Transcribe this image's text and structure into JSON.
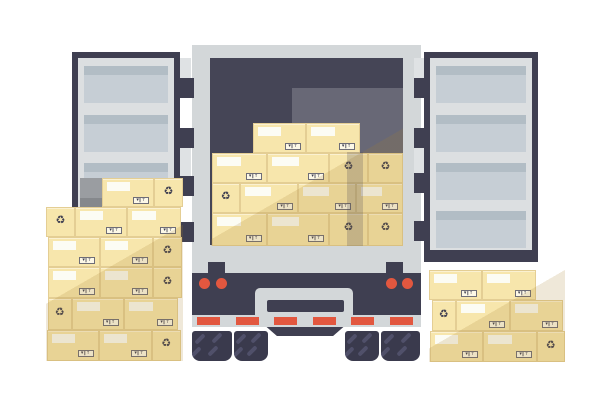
{
  "title": "Flat vector illustration: rear view of a box truck with both cargo doors open, loaded with cardboard boxes, and stacks of cardboard boxes on the ground at the left and right",
  "colors": {
    "background": "#FFFFFF",
    "navy": "#3F3F51",
    "interior": "#454556",
    "interior_light": "#686876",
    "body_gray": "#D3D7D9",
    "door_inner": "#DCDFE1",
    "panel": "#C6CED5",
    "panel_top": "#B2BDC5",
    "hinge_gray": "#DFE2E4",
    "red": "#E2573F",
    "wheel": "#3A3A4D",
    "tread": "#50506A",
    "box_cream": "#F7E6AC",
    "box_border": "#E4CE94",
    "box_label": "#FCFCF4",
    "glyph": "#3F3F51",
    "stack_shadow": "rgba(166,126,44,0.18)",
    "interior_band": "rgba(63,63,81,0.22)",
    "gray_box_top": "#9A9DA1",
    "gray_box_bottom": "#85888C"
  },
  "truck": {
    "body": [
      192,
      45,
      229,
      282
    ],
    "opening": [
      210,
      58,
      193,
      187
    ],
    "interior_light": [
      292,
      88,
      111,
      157
    ],
    "interior_band": [
      347,
      152,
      16,
      93.5
    ],
    "bumper_band": [
      192,
      273,
      229,
      42
    ],
    "tail_lights": [
      [
        198.5,
        277.5
      ],
      [
        215.5,
        277.5
      ],
      [
        385.5,
        277.5
      ],
      [
        402,
        277.5
      ]
    ],
    "light_d": 11,
    "step": [
      255,
      288,
      98,
      27
    ],
    "plate": [
      267,
      300,
      77,
      12
    ],
    "reflector_dashes": [
      [
        197,
        316.5
      ],
      [
        235.5,
        316.5
      ],
      [
        274,
        316.5
      ],
      [
        312.5,
        316.5
      ],
      [
        351,
        316.5
      ],
      [
        390,
        316.5
      ]
    ],
    "dash_size": [
      23,
      8.5
    ],
    "brackets": [
      [
        208,
        262,
        17,
        11
      ],
      [
        386,
        262,
        17,
        11
      ]
    ],
    "underbody": [
      266,
      326.5,
      78,
      9.5
    ],
    "wheels": [
      [
        192,
        331,
        40,
        30
      ],
      [
        234,
        331,
        34,
        30
      ],
      [
        345,
        331,
        34,
        30
      ],
      [
        381,
        331,
        39,
        30
      ]
    ],
    "tread_spots": [
      [
        0.16,
        0.08
      ],
      [
        0.58,
        0.04
      ],
      [
        0.06,
        0.5
      ],
      [
        0.48,
        0.46
      ]
    ]
  },
  "doors": {
    "left": {
      "frame": [
        72,
        52,
        108,
        210
      ],
      "inner": [
        78,
        58,
        96,
        192
      ],
      "panel_x": [
        84,
        84
      ],
      "panels": [
        [
          66,
          37
        ],
        [
          115,
          37
        ],
        [
          163,
          37
        ],
        [
          211,
          37
        ]
      ],
      "hinge_blocks": [
        [
          180,
          78,
          14,
          20
        ],
        [
          180,
          128,
          14,
          20
        ],
        [
          180,
          176,
          14,
          20
        ],
        [
          180,
          222,
          14,
          20
        ]
      ],
      "hinge_grays": [
        [
          180,
          58,
          11,
          20
        ],
        [
          180,
          148,
          11,
          28
        ]
      ]
    },
    "right": {
      "frame": [
        424,
        52,
        114,
        210
      ],
      "inner": [
        430,
        58,
        102,
        192
      ],
      "panel_x": [
        436,
        90
      ],
      "panels": [
        [
          66,
          37
        ],
        [
          115,
          37
        ],
        [
          163,
          37
        ],
        [
          211,
          37
        ]
      ],
      "hinge_blocks": [
        [
          414,
          78,
          16,
          20
        ],
        [
          414,
          128,
          16,
          20
        ],
        [
          414,
          173,
          16,
          20
        ],
        [
          414,
          221,
          16,
          20
        ]
      ],
      "hinge_grays": [
        [
          414,
          58,
          10,
          20
        ],
        [
          414,
          148,
          10,
          25
        ]
      ]
    }
  },
  "gray_box": [
    80,
    177.5,
    21.5,
    29.5
  ],
  "stacks": {
    "interior": {
      "bounds": [
        211,
        122,
        192,
        123.5
      ],
      "shadow_stop": 50,
      "boxes": [
        [
          253,
          122.5,
          53,
          30.5,
          "l"
        ],
        [
          306,
          122.5,
          53.5,
          30.5,
          "l"
        ],
        [
          211.5,
          152.5,
          55,
          30.5,
          "l"
        ],
        [
          266.5,
          152.5,
          62.5,
          30.5,
          "l"
        ],
        [
          329,
          152.5,
          39,
          30.5,
          "r"
        ],
        [
          368,
          152.5,
          35,
          30.5,
          "r"
        ],
        [
          211.5,
          183,
          28.5,
          30,
          "r"
        ],
        [
          240,
          183,
          58,
          30,
          "l"
        ],
        [
          298,
          183,
          58,
          30,
          "l"
        ],
        [
          356,
          183,
          47,
          30,
          "l"
        ],
        [
          211.5,
          213,
          55,
          32.5,
          "l"
        ],
        [
          266.5,
          213,
          62.5,
          32.5,
          "l"
        ],
        [
          329,
          213,
          39,
          32.5,
          "r"
        ],
        [
          368,
          213,
          35,
          32.5,
          "r"
        ]
      ]
    },
    "left": {
      "bounds": [
        46,
        177.5,
        137,
        183
      ],
      "shadow_stop": 48,
      "boxes": [
        [
          101.5,
          177.5,
          52.5,
          29.5,
          "l"
        ],
        [
          154,
          177.5,
          29,
          29.5,
          "r"
        ],
        [
          46,
          207,
          29,
          30,
          "r"
        ],
        [
          75,
          207,
          52,
          30,
          "l"
        ],
        [
          127,
          207,
          54,
          30,
          "l"
        ],
        [
          47.5,
          237,
          52.5,
          30,
          "l"
        ],
        [
          100,
          237,
          53,
          30,
          "l"
        ],
        [
          153,
          237,
          29,
          30,
          "r"
        ],
        [
          47.5,
          267,
          52.5,
          31,
          "l"
        ],
        [
          100,
          267,
          53,
          31,
          "l"
        ],
        [
          153,
          267,
          29,
          31,
          "r"
        ],
        [
          47.5,
          298,
          24.5,
          31.5,
          "r"
        ],
        [
          72,
          298,
          51.5,
          31.5,
          "l"
        ],
        [
          123.5,
          298,
          54.5,
          31.5,
          "l"
        ],
        [
          46.5,
          329.5,
          52,
          31,
          "l"
        ],
        [
          98.5,
          329.5,
          53.5,
          31,
          "l"
        ],
        [
          152,
          329.5,
          28.5,
          31,
          "r"
        ]
      ]
    },
    "right": {
      "bounds": [
        429,
        270,
        136,
        91.5
      ],
      "shadow_stop": 46,
      "boxes": [
        [
          429,
          270,
          52.5,
          30,
          "l"
        ],
        [
          481.5,
          270,
          54,
          30,
          "l"
        ],
        [
          431.5,
          300,
          24.5,
          31,
          "r"
        ],
        [
          456,
          300,
          54,
          31,
          "l"
        ],
        [
          510,
          300,
          53,
          31,
          "l"
        ],
        [
          430,
          331,
          53,
          30.5,
          "l"
        ],
        [
          483,
          331,
          54,
          30.5,
          "l"
        ],
        [
          537,
          331,
          27.5,
          30.5,
          "r"
        ]
      ]
    }
  },
  "box_style": {
    "label_w_pct": 46,
    "label_h": 9,
    "shipping_symbols": "▾‖↑",
    "recycle_glyph": "♻"
  }
}
